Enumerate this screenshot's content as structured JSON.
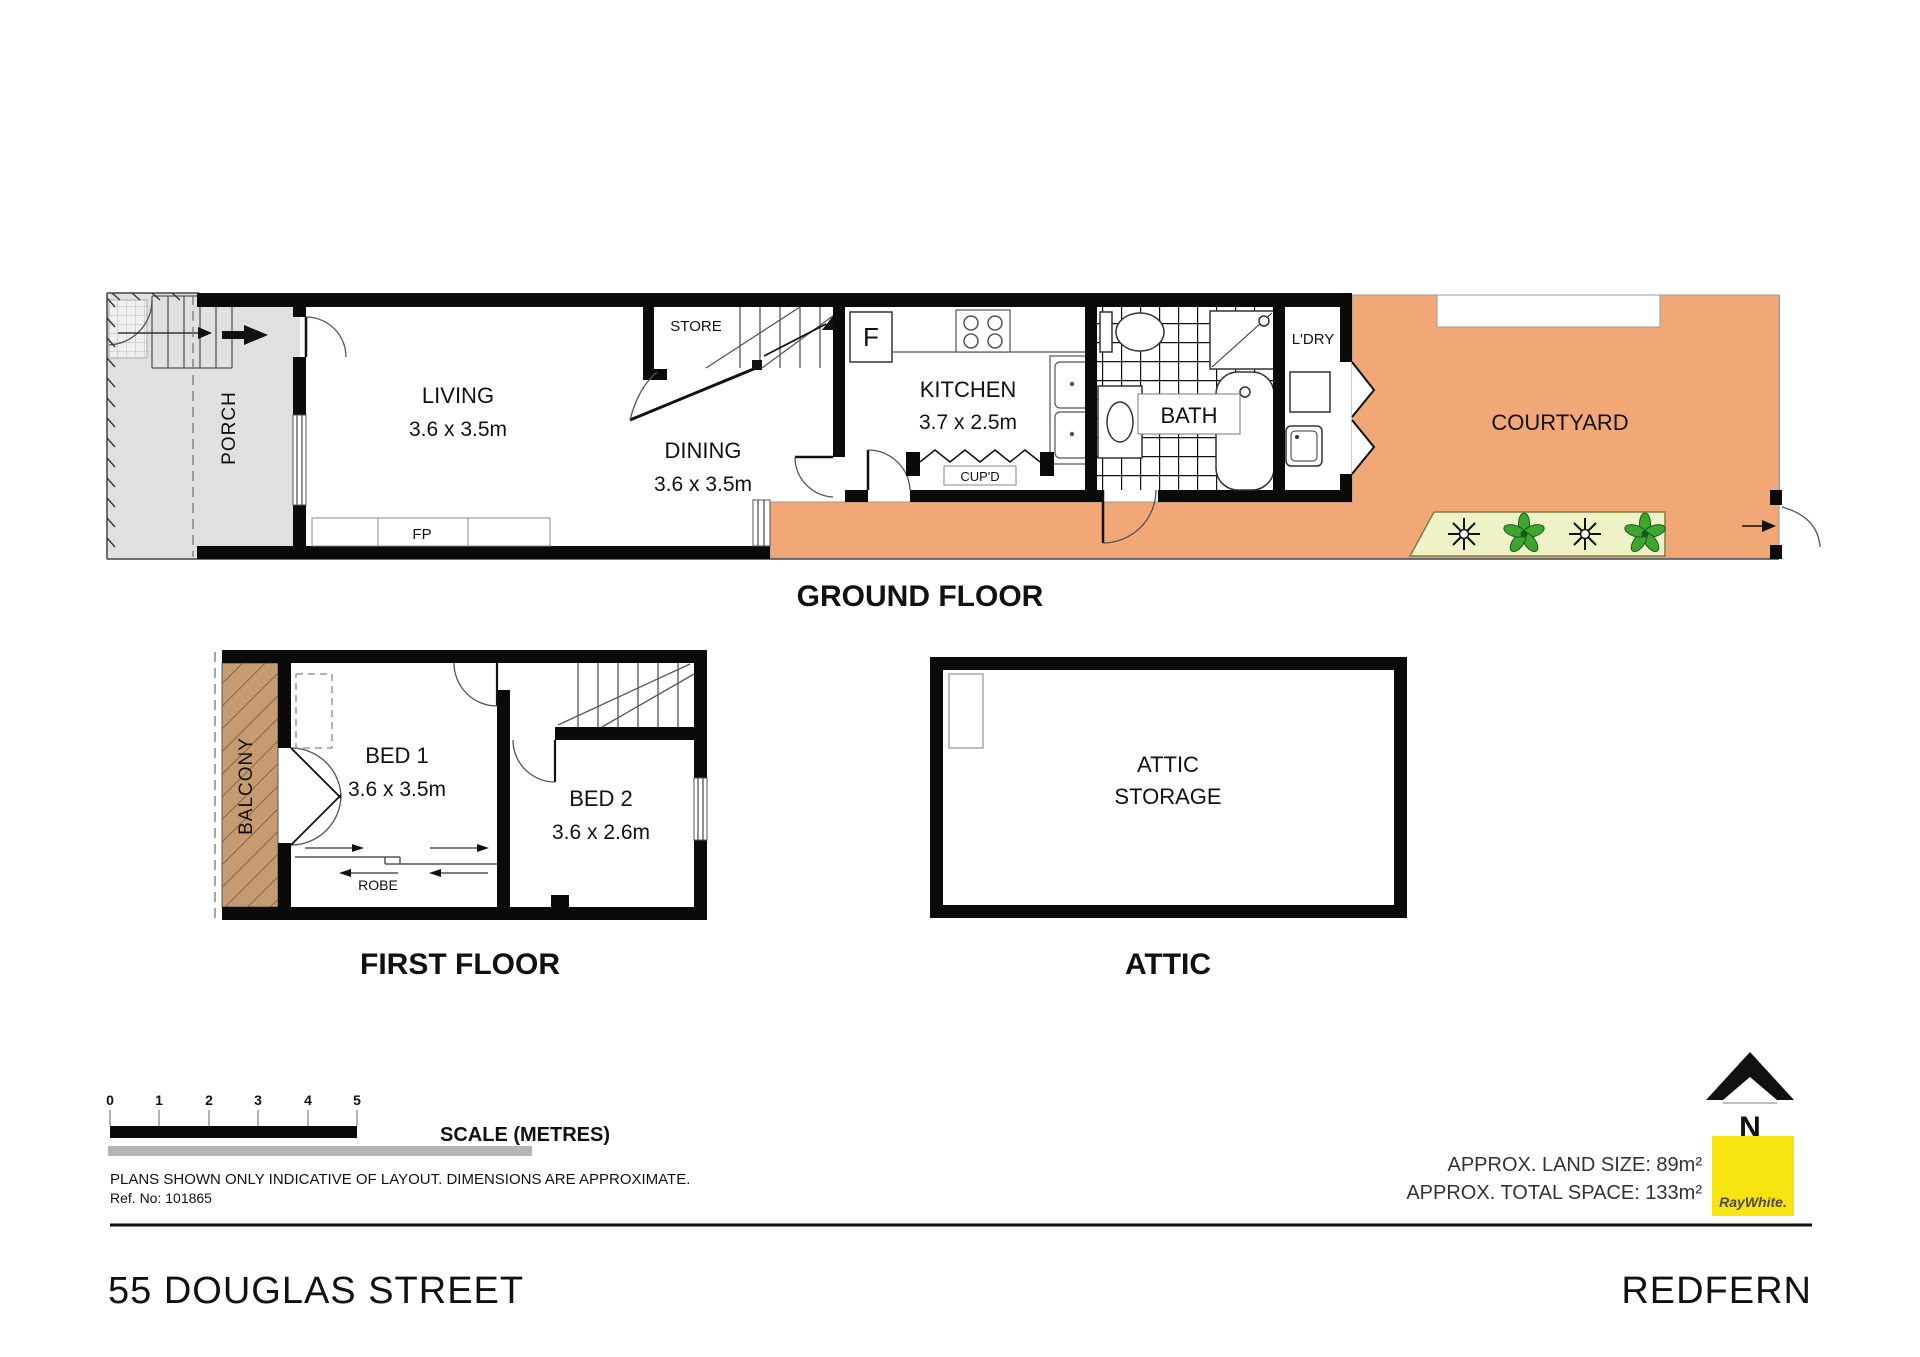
{
  "page": {
    "address": "55 DOUGLAS STREET",
    "suburb": "REDFERN"
  },
  "scalebar": {
    "ticks": [
      "0",
      "1",
      "2",
      "3",
      "4",
      "5"
    ],
    "label": "SCALE (METRES)",
    "disclaimer": "PLANS SHOWN ONLY INDICATIVE OF LAYOUT.  DIMENSIONS ARE APPROXIMATE.",
    "ref": "Ref. No: 101865"
  },
  "info": {
    "land": "APPROX. LAND SIZE: 89m²",
    "space": "APPROX. TOTAL SPACE: 133m²",
    "north": "N",
    "brand": "RayWhite."
  },
  "ground": {
    "caption": "GROUND FLOOR",
    "porch": "PORCH",
    "living": "LIVING",
    "living_dim": "3.6 x 3.5m",
    "store": "STORE",
    "dining": "DINING",
    "dining_dim": "3.6 x 3.5m",
    "fridge": "F",
    "kitchen": "KITCHEN",
    "kitchen_dim": "3.7 x 2.5m",
    "cupboard": "CUP'D",
    "fireplace": "FP",
    "bath": "BATH",
    "laundry": "L'DRY",
    "courtyard": "COURTYARD"
  },
  "first": {
    "caption": "FIRST FLOOR",
    "balcony": "BALCONY",
    "bed1": "BED 1",
    "bed1_dim": "3.6 x 3.5m",
    "bed2": "BED 2",
    "bed2_dim": "3.6 x 2.6m",
    "robe": "ROBE"
  },
  "attic": {
    "caption": "ATTIC",
    "line1": "ATTIC",
    "line2": "STORAGE"
  },
  "colors": {
    "courtyard": "#F2A777",
    "balcony": "#C69B72",
    "porch": "#E0E0E0",
    "garden_bed": "#EFF2C6",
    "plant_green": "#3FA52E",
    "brand_yellow": "#F8E411",
    "scale_grey": "#B5B5B5",
    "wall_black": "#0A0A0A"
  }
}
